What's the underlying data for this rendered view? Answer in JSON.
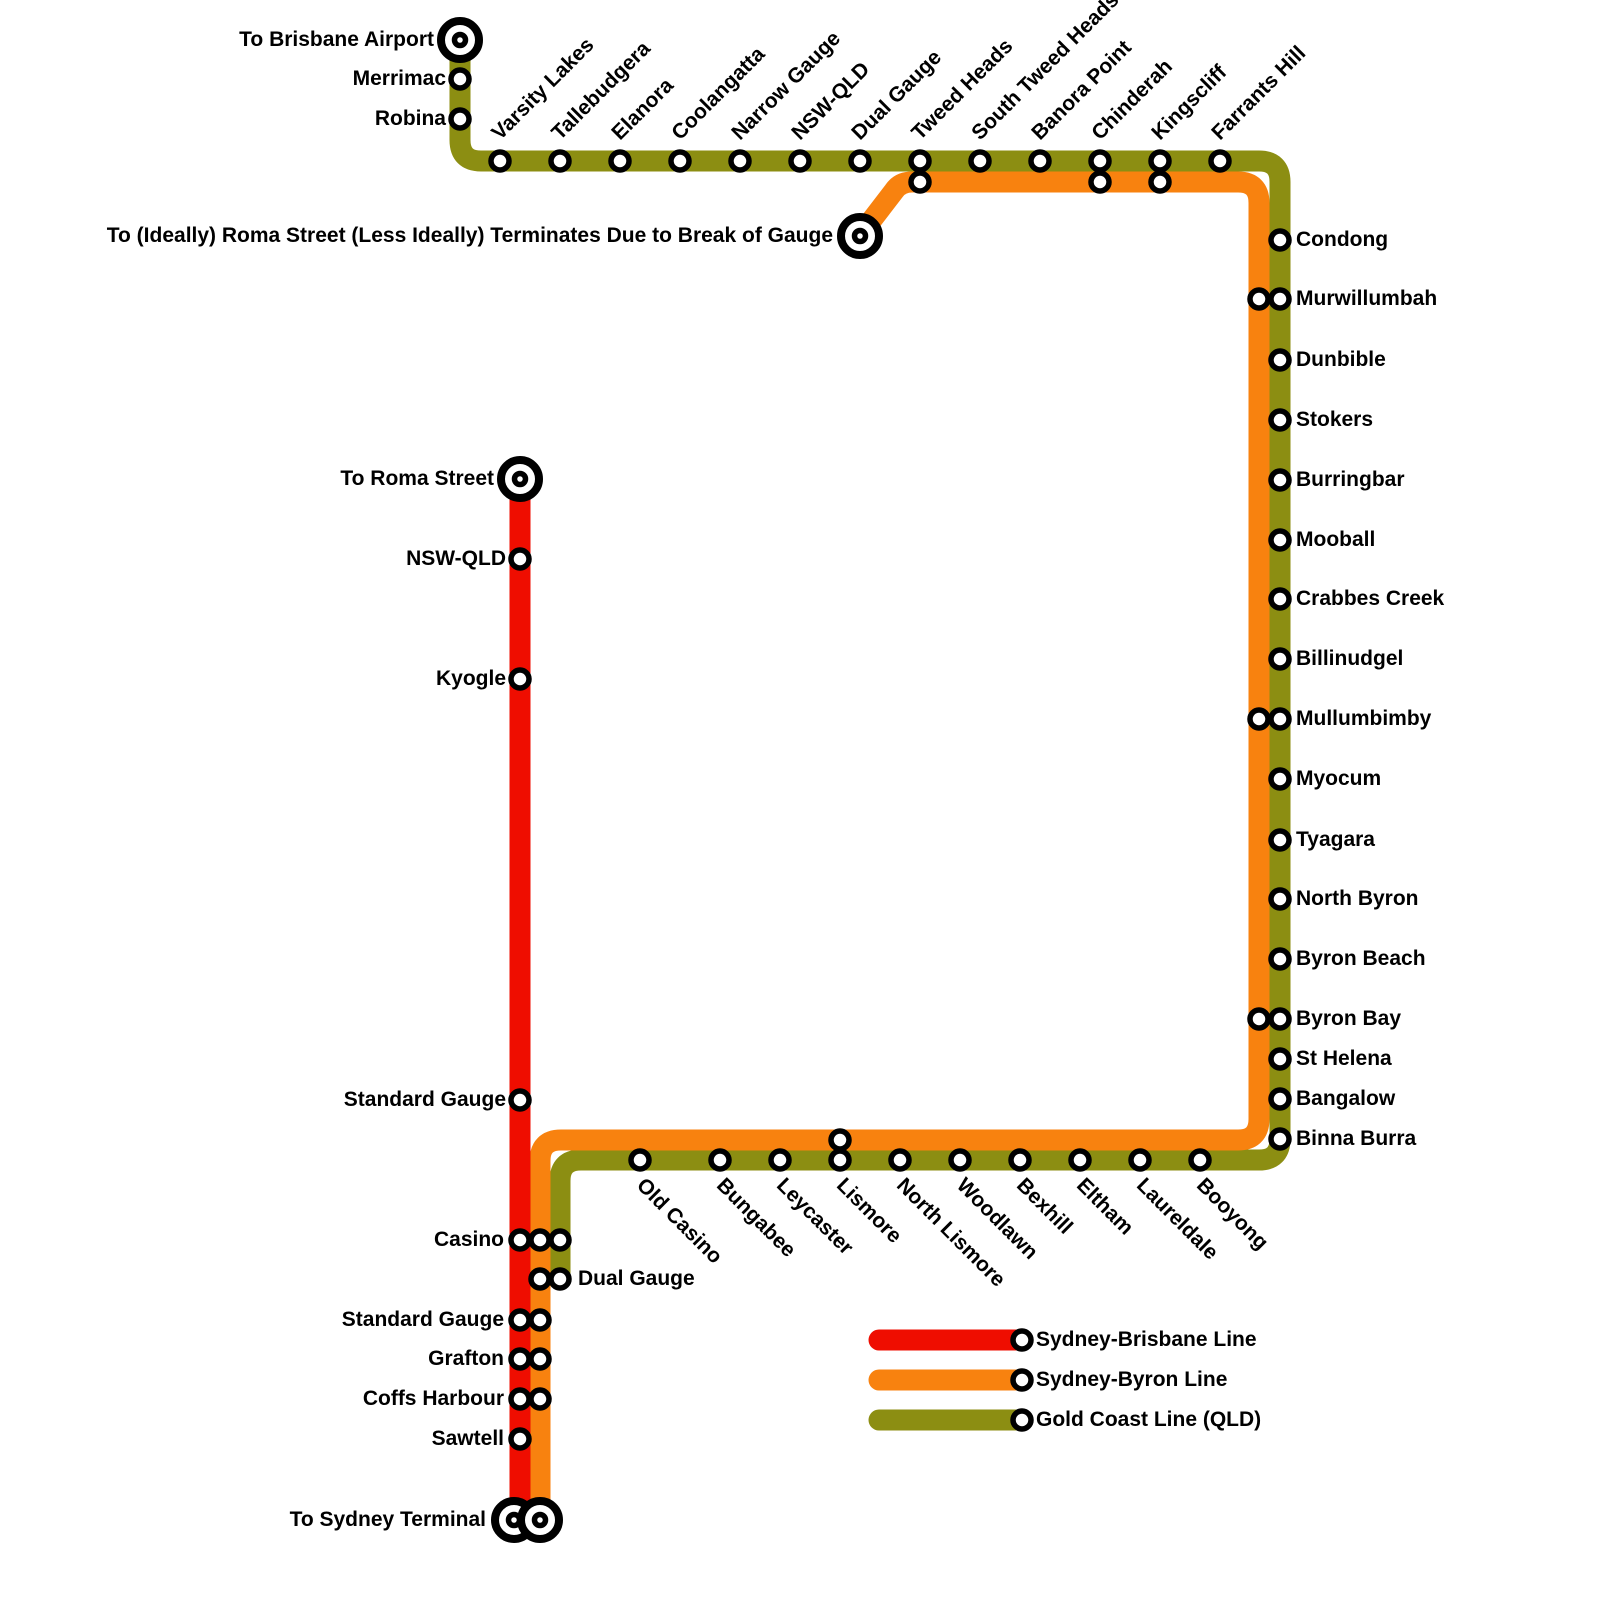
{
  "lines": {
    "sydney_brisbane": {
      "label": "Sydney-Brisbane Line",
      "color": "#EF0D00"
    },
    "sydney_byron": {
      "label": "Sydney-Byron Line",
      "color": "#F8820F"
    },
    "gold_coast": {
      "label": "Gold Coast Line (QLD)",
      "color": "#8C8E12"
    }
  },
  "termini": {
    "brisbane_airport": "To Brisbane Airport",
    "break_of_gauge": "To (Ideally) Roma Street (Less Ideally) Terminates Due to Break of Gauge",
    "roma_street": "To Roma Street",
    "sydney_terminal": "To Sydney Terminal"
  },
  "stations": {
    "airport_branch": [
      "Merrimac",
      "Robina"
    ],
    "gold_coast_row": [
      "Varsity Lakes",
      "Tallebudgera",
      "Elanora",
      "Coolangatta",
      "Narrow Gauge",
      "NSW-QLD",
      "Dual Gauge",
      "Tweed Heads",
      "South Tweed Heads",
      "Banora Point",
      "Chinderah",
      "Kingscliff",
      "Farrants Hill"
    ],
    "tweed_byron_column": [
      "Condong",
      "Murwillumbah",
      "Dunbible",
      "Stokers",
      "Burringbar",
      "Mooball",
      "Crabbes Creek",
      "Billinudgel",
      "Mullumbimby",
      "Myocum",
      "Tyagara",
      "North Byron",
      "Byron Beach",
      "Byron Bay",
      "St Helena",
      "Bangalow",
      "Binna Burra"
    ],
    "lismore_row": [
      "Old Casino",
      "Bungabee",
      "Leycaster",
      "Lismore",
      "North Lismore",
      "Woodlawn",
      "Bexhill",
      "Eltham",
      "Laureldale",
      "Booyong"
    ],
    "south_column": [
      "NSW-QLD",
      "Kyogle",
      "Standard Gauge",
      "Casino",
      "Dual Gauge",
      "Standard Gauge",
      "Grafton",
      "Coffs Harbour",
      "Sawtell"
    ]
  }
}
